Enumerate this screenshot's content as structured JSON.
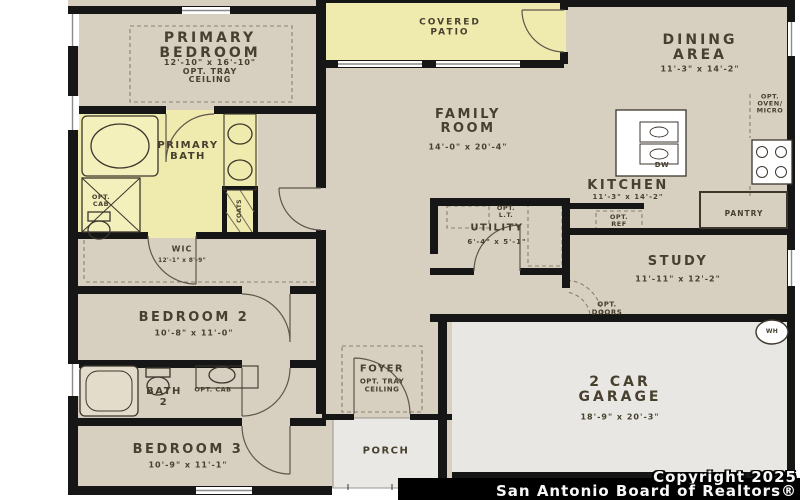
{
  "plan": {
    "colors": {
      "floor_beige": "#d7cfc0",
      "accent_yellow": "#efeaad",
      "garage_gray": "#e9e7e3",
      "wall_black": "#161616",
      "label_text": "#48402f"
    },
    "rooms": {
      "primary_bedroom": {
        "name_l1": "PRIMARY",
        "name_l2": "BEDROOM",
        "dims": "12'-10\" x 16'-10\"",
        "note_l1": "OPT. TRAY",
        "note_l2": "CEILING"
      },
      "covered_patio": {
        "name_l1": "COVERED",
        "name_l2": "PATIO"
      },
      "dining_area": {
        "name_l1": "DINING",
        "name_l2": "AREA",
        "dims": "11'-3\" x 14'-2\""
      },
      "family_room": {
        "name_l1": "FAMILY",
        "name_l2": "ROOM",
        "dims": "14'-0\" x 20'-4\""
      },
      "kitchen": {
        "name": "KITCHEN",
        "dims": "11'-3\" x 14'-2\""
      },
      "primary_bath": {
        "name_l1": "PRIMARY",
        "name_l2": "BATH"
      },
      "wic": {
        "name": "WIC",
        "dims": "12'-1\" x 8'-9\""
      },
      "utility": {
        "name": "UTILITY",
        "dims": "6'-4\" x 5'-1\""
      },
      "study": {
        "name": "STUDY",
        "dims": "11'-11\" x 12'-2\""
      },
      "bedroom_2": {
        "name": "BEDROOM 2",
        "dims": "10'-8\" x 11'-0\""
      },
      "bath_2": {
        "name_l1": "BATH",
        "name_l2": "2"
      },
      "bedroom_3": {
        "name": "BEDROOM 3",
        "dims": "10'-9\" x 11'-1\""
      },
      "foyer": {
        "name": "FOYER",
        "note_l1": "OPT. TRAY",
        "note_l2": "CEILING"
      },
      "porch": {
        "name": "PORCH"
      },
      "garage": {
        "name_l1": "2 CAR",
        "name_l2": "GARAGE",
        "dims": "18'-9\" x 20'-3\""
      }
    },
    "annotations": {
      "opt_cab_l1": "OPT.",
      "opt_cab_l2": "CAB",
      "opt_cab_bath2": "OPT. CAB",
      "coats": "COATS",
      "opt_lt_l1": "OPT.",
      "opt_lt_l2": "L.T.",
      "opt_ref_l1": "OPT.",
      "opt_ref_l2": "REF",
      "opt_oven_l1": "OPT.",
      "opt_oven_l2": "OVEN/",
      "opt_oven_l3": "MICRO",
      "dw": "DW",
      "pantry": "PANTRY",
      "opt_doors_l1": "OPT.",
      "opt_doors_l2": "DOORS",
      "wh": "WH"
    },
    "footer": {
      "line1": "Copyright 2025",
      "line2": "San Antonio Board of Realtors®"
    }
  }
}
